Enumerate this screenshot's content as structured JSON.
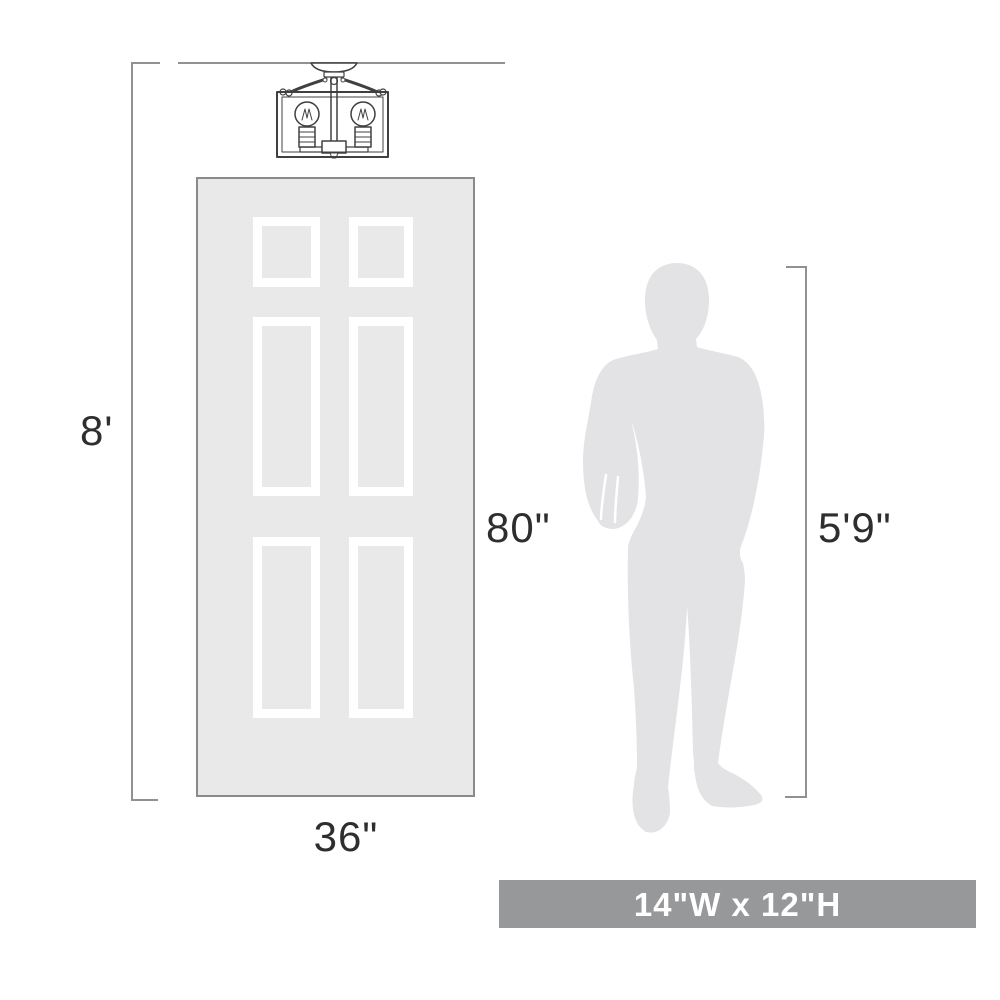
{
  "diagram": {
    "measurements": {
      "ceiling_height": "8'",
      "door_height": "80\"",
      "door_width": "36\"",
      "person_height": "5'9\"",
      "fixture_size": "14\"W x 12\"H"
    },
    "objects": {
      "fixture": "two-light caged semi-flush ceiling light",
      "door": "six-panel door",
      "person": "standing man silhouette"
    },
    "colors": {
      "background": "#ffffff",
      "dimension_line": "#919191",
      "fixture_line": "#404040",
      "door_fill": "#e9e9e9",
      "door_border": "#8a8a8a",
      "panel_border": "#ffffff",
      "silhouette": "#e3e3e5",
      "label_text": "#2e2e2e",
      "banner_bg": "#97989a",
      "banner_text": "#ffffff"
    }
  }
}
